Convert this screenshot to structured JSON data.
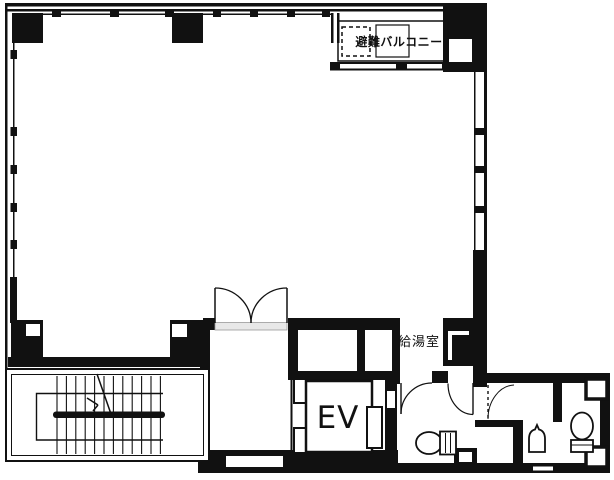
{
  "title": "building-floor-plan",
  "colors": {
    "wall": "#111111",
    "background": "#ffffff",
    "door_sill": "#e8e8e8"
  },
  "labels": {
    "balcony": "避難バルコニー",
    "kitchenette": "給湯室",
    "elevator": "EV"
  }
}
